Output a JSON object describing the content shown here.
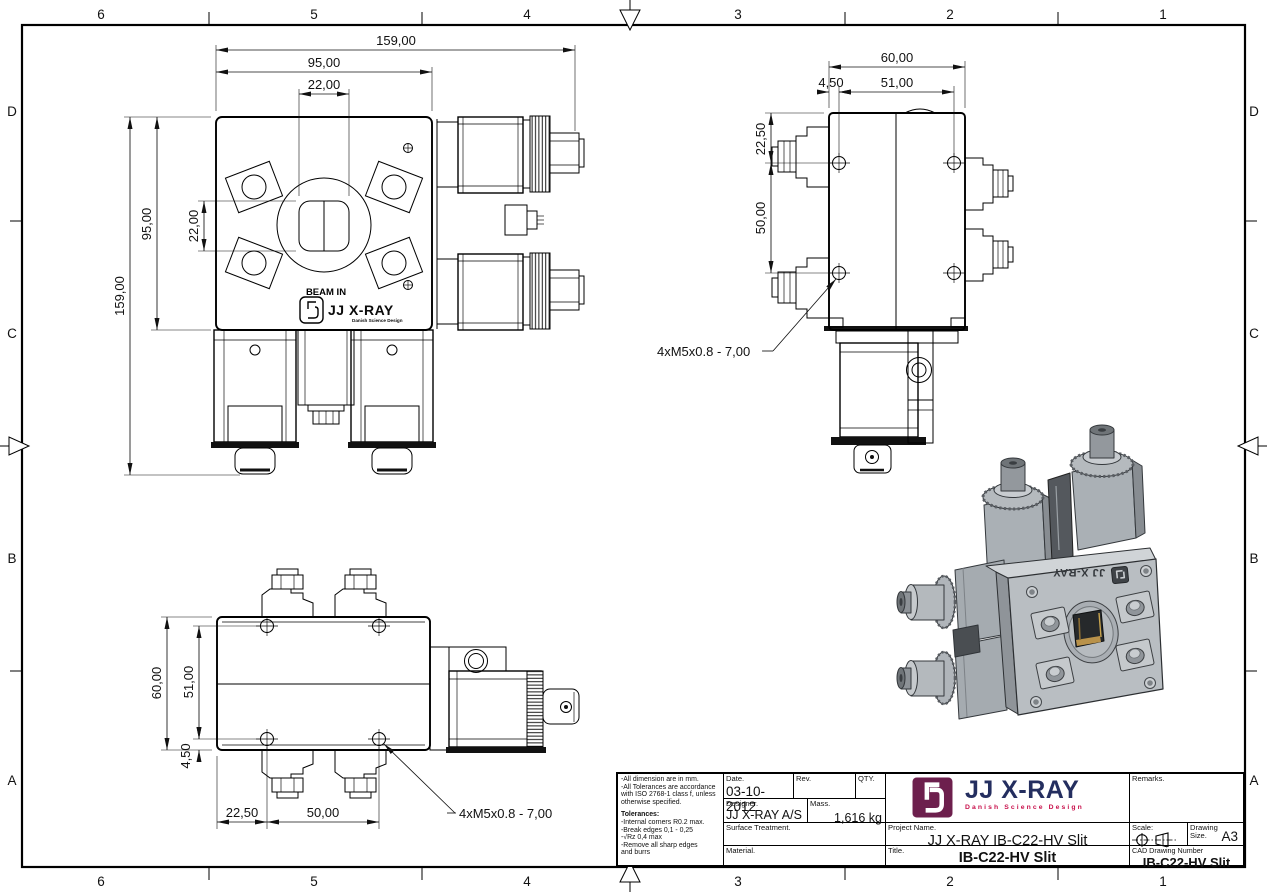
{
  "sheet": {
    "grid_cols": [
      "6",
      "5",
      "4",
      "3",
      "2",
      "1"
    ],
    "grid_rows": [
      "D",
      "C",
      "B",
      "A"
    ]
  },
  "front": {
    "dim_w_total": "159,00",
    "dim_w_body": "95,00",
    "dim_w_slit": "22,00",
    "dim_h_total": "159,00",
    "dim_h_body": "95,00",
    "dim_h_slit": "22,00",
    "beam_in": "BEAM IN",
    "brand": "JJ X-RAY",
    "brand_sub": "Danish Science Design"
  },
  "side": {
    "dim_w": "60,00",
    "dim_offset": "4,50",
    "dim_holes_w": "51,00",
    "dim_top": "22,50",
    "dim_holes_h": "50,00",
    "thread_note": "4xM5x0.8 - 7,00"
  },
  "bottom": {
    "dim_h": "60,00",
    "dim_holes_h": "51,00",
    "dim_offset": "4,50",
    "dim_left": "22,50",
    "dim_holes_w": "50,00",
    "thread_note": "4xM5x0.8 - 7,00"
  },
  "iso": {
    "brand": "JJ X-RAY"
  },
  "title_block": {
    "notes": [
      "-All dimension are in mm.",
      "-All Tolerances are accordance",
      "with ISO 2768-1 class f, unless",
      "otherwise specified.",
      "Tolerances:",
      "-Internal corners R0.2 max.",
      "-Break edges 0,1 - 0,25",
      "-√Rz 0,4 max",
      "-Remove all sharp edges",
      "and burrs"
    ],
    "date_label": "Date.",
    "date_value": "03-10-2012",
    "rev_label": "Rev.",
    "qty_label": "QTY.",
    "designer_label": "Designer.",
    "designer_value": "JJ X-RAY A/S",
    "mass_label": "Mass.",
    "mass_value": "1,616 kg",
    "surface_label": "Surface Treatment.",
    "material_label": "Material.",
    "project_label": "Project Name.",
    "project_value": "JJ X-RAY IB-C22-HV Slit",
    "title_label": "Title.",
    "title_value": "IB-C22-HV Slit",
    "remarks_label": "Remarks.",
    "scale_label": "Scale:",
    "size_label_1": "Drawing",
    "size_label_2": "Size.",
    "size_value": "A3",
    "cad_label": "CAD Drawing Number",
    "cad_value": "IB-C22-HV Slit",
    "brand": "JJ X-RAY",
    "brand_sub": "Danish Science Design"
  },
  "colors": {
    "line": "#000000",
    "logo_bg": "#6d1f4d",
    "brand_text": "#242e5f",
    "brand_sub": "#c8104b",
    "render_gray": "#b9bec2"
  }
}
